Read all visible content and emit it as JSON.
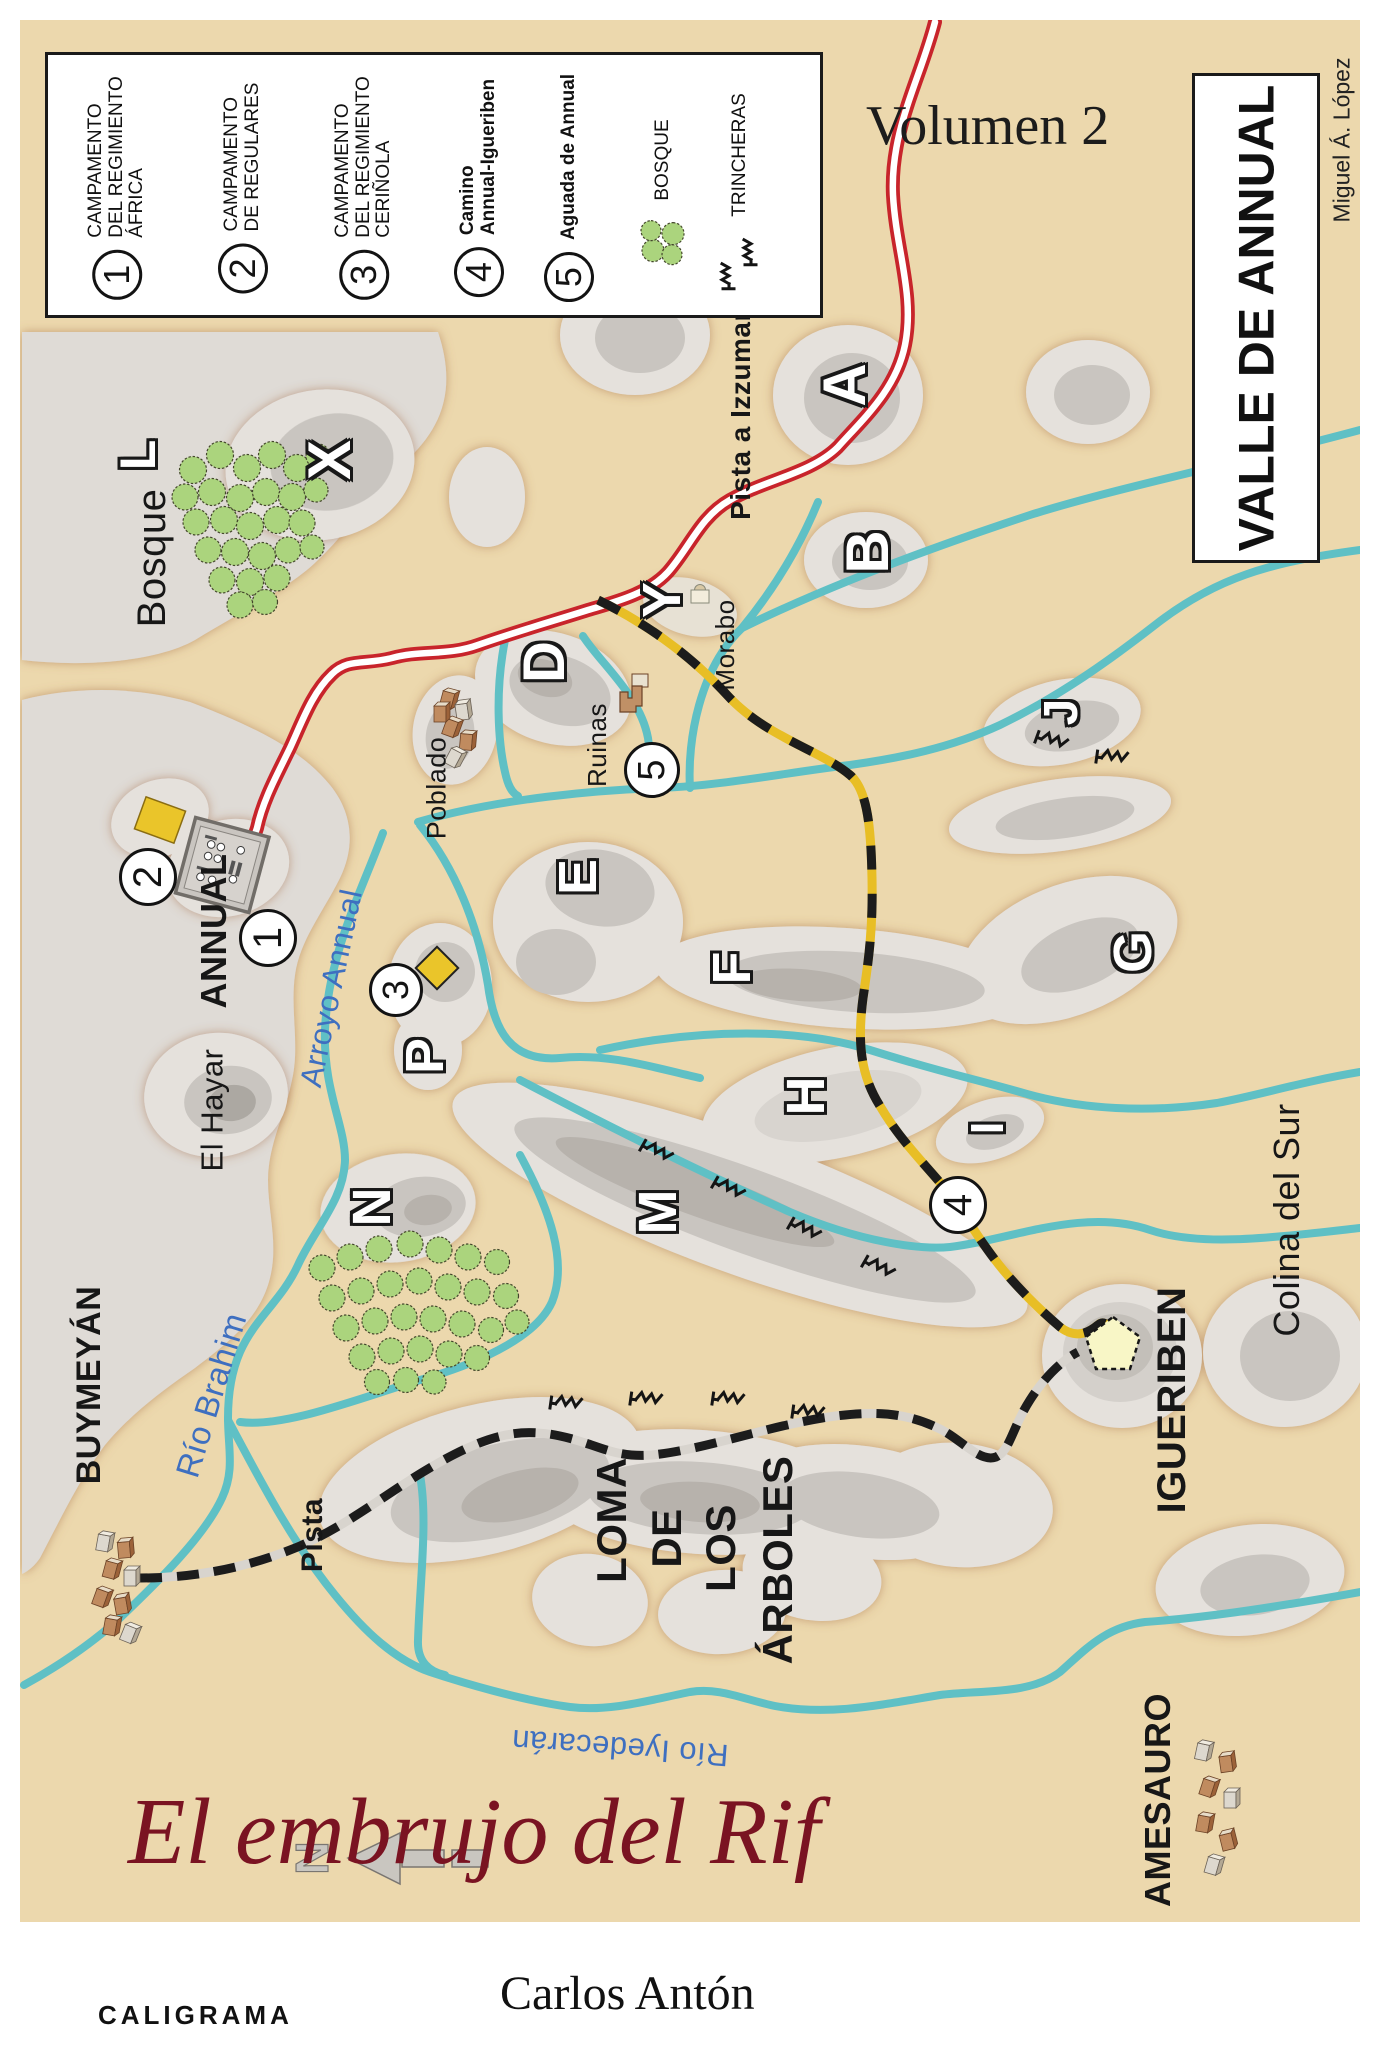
{
  "page": {
    "volume": "Volumen 2",
    "map_title": "VALLE DE ANNUAL",
    "credit": "Miguel Á. López",
    "book_title": "El embrujo del Rif",
    "author": "Carlos Antón",
    "publisher": "CALIGRAMA"
  },
  "legend": {
    "items": [
      {
        "num": "1",
        "label": "CAMPAMENTO\nDEL REGIMIENTO\nÁFRICA"
      },
      {
        "num": "2",
        "label": "CAMPAMENTO\nDE REGULARES"
      },
      {
        "num": "3",
        "label": "CAMPAMENTO\nDEL REGIMIENTO\nCERIÑOLA"
      },
      {
        "num": "4",
        "label": "Camino\nAnnual-Igueriben"
      },
      {
        "num": "5",
        "label": "Aguada de Annual"
      }
    ],
    "bosque": "BOSQUE",
    "trincheras": "TRINCHERAS"
  },
  "map": {
    "markers": {
      "m1": "1",
      "m2": "2",
      "m3": "3",
      "m4": "4",
      "m5": "5"
    },
    "letters": {
      "l": "L",
      "x": "X",
      "a": "A",
      "b": "B",
      "y": "Y",
      "d": "D",
      "e": "E",
      "f": "F",
      "g": "G",
      "j": "J",
      "h": "H",
      "i": "I",
      "m": "M",
      "n": "N",
      "p": "P"
    },
    "places": {
      "bosque": "Bosque",
      "pista_izzumar": "Pista a Izzumar",
      "morabo": "Morabo",
      "ruinas": "Ruinas",
      "poblado": "Poblado",
      "annual": "ANNUAL",
      "el_hayar": "El Hayar",
      "buymeyan": "BUYMEYÁN",
      "pista": "Pista",
      "loma_1": "LOMA",
      "loma_2": "DE",
      "loma_3": "LOS",
      "loma_4": "ÁRBOLES",
      "igueriben": "IGUERIBEN",
      "colina": "Colina del Sur",
      "amesauro": "AMESAURO",
      "north": "N"
    },
    "rivers": {
      "arroyo_annual": "Arroyo Annual",
      "rio_brahim": "Río Brahim",
      "rio_iyedecaran": "Río Iyedecarán"
    },
    "colors": {
      "land": "#ECD8AD",
      "plateau": "#DFDBD6",
      "river": "#5FC0C5",
      "road_red": "#C8242B",
      "camino_yellow": "#E8BE25",
      "trail_black": "#1C1C1C",
      "tree_green": "#ABD47D",
      "camp_yellow": "#EAC52A",
      "title_red": "#7A1322",
      "label_blue": "#3E6FC0"
    }
  }
}
